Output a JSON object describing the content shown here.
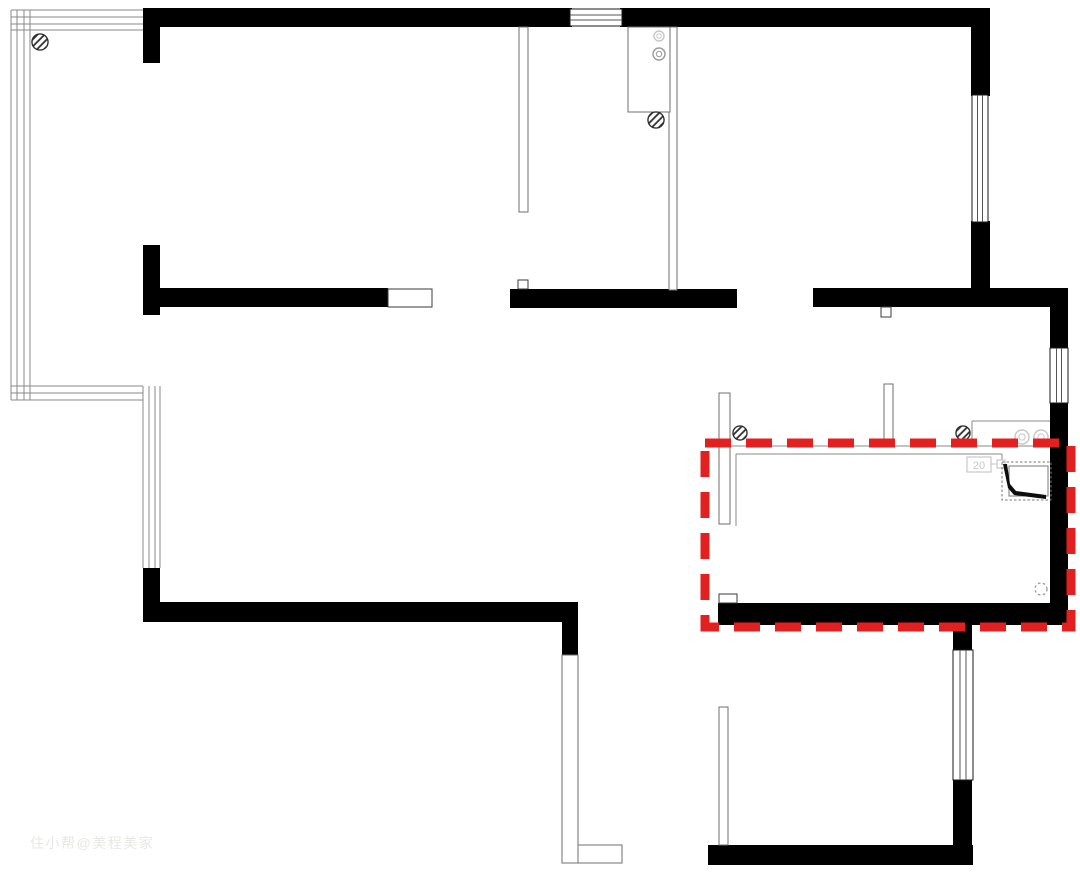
{
  "canvas": {
    "w": 1080,
    "h": 875,
    "bg": "#ffffff"
  },
  "colors": {
    "wall": "#000000",
    "thin": "#8a8a8a",
    "frame": "#3a3a3a",
    "partition": "#6f6f6f",
    "window_frame": "#1a1a1a",
    "window_mullion": "#555555",
    "fixture": "#9a9a9a",
    "faint": "#c7c7c7",
    "red": "#e32020",
    "watermark": "#e7e7e4"
  },
  "watermark": {
    "text": "住小帮@美程美家"
  },
  "labels": {
    "washer_label": "20"
  },
  "floorplan": {
    "highlight": {
      "x": 705,
      "y": 443,
      "w": 366,
      "h": 184,
      "stroke_width": 9,
      "dash": "26 15"
    },
    "walls": [
      {
        "x": 143,
        "y": 8,
        "w": 429,
        "h": 19
      },
      {
        "x": 620,
        "y": 8,
        "w": 370,
        "h": 19
      },
      {
        "x": 143,
        "y": 8,
        "w": 17,
        "h": 55
      },
      {
        "x": 971,
        "y": 8,
        "w": 19,
        "h": 88
      },
      {
        "x": 971,
        "y": 221,
        "w": 19,
        "h": 86
      },
      {
        "x": 813,
        "y": 288,
        "w": 255,
        "h": 19
      },
      {
        "x": 1050,
        "y": 307,
        "w": 18,
        "h": 42
      },
      {
        "x": 1050,
        "y": 402,
        "w": 18,
        "h": 223
      },
      {
        "x": 510,
        "y": 289,
        "w": 227,
        "h": 19
      },
      {
        "x": 143,
        "y": 245,
        "w": 17,
        "h": 70
      },
      {
        "x": 160,
        "y": 288,
        "w": 228,
        "h": 19
      },
      {
        "x": 143,
        "y": 568,
        "w": 17,
        "h": 54
      },
      {
        "x": 160,
        "y": 602,
        "w": 418,
        "h": 20
      },
      {
        "x": 562,
        "y": 602,
        "w": 16,
        "h": 53
      },
      {
        "x": 718,
        "y": 603,
        "w": 350,
        "h": 22
      },
      {
        "x": 953,
        "y": 625,
        "w": 19,
        "h": 26
      },
      {
        "x": 953,
        "y": 779,
        "w": 19,
        "h": 86
      },
      {
        "x": 708,
        "y": 845,
        "w": 265,
        "h": 20
      }
    ],
    "windows": [
      {
        "x": 570,
        "y": 9,
        "w": 52,
        "h": 17,
        "o": "h"
      },
      {
        "x": 972,
        "y": 95,
        "w": 16,
        "h": 127,
        "o": "v"
      },
      {
        "x": 1050,
        "y": 348,
        "w": 18,
        "h": 55,
        "o": "v"
      },
      {
        "x": 953,
        "y": 650,
        "w": 20,
        "h": 130,
        "o": "v"
      }
    ],
    "bay": {
      "v_x": [
        11,
        17,
        24,
        30
      ],
      "v_y1": 10,
      "v_y2": 400,
      "h_y": [
        10,
        17,
        24,
        30
      ],
      "h_x1": 11,
      "h_x2": 143,
      "b_y": [
        386,
        393,
        400
      ],
      "b_x1": 11,
      "b_x2": 143,
      "c_x": [
        143,
        149,
        155,
        160
      ],
      "c_y1": 386,
      "c_y2": 568
    },
    "partitions": [
      {
        "x": 519,
        "y": 27,
        "w": 9,
        "h": 185,
        "n": "partition"
      },
      {
        "x": 669,
        "y": 27,
        "w": 8,
        "h": 263,
        "n": "partition"
      },
      {
        "x": 884,
        "y": 384,
        "w": 9,
        "h": 62,
        "n": "partition"
      },
      {
        "x": 719,
        "y": 393,
        "w": 11,
        "h": 131,
        "n": "partition"
      },
      {
        "x": 719,
        "y": 707,
        "w": 9,
        "h": 138,
        "n": "partition"
      },
      {
        "x": 562,
        "y": 655,
        "w": 16,
        "h": 208,
        "n": "balcony-railing"
      },
      {
        "x": 578,
        "y": 845,
        "w": 44,
        "h": 18,
        "n": "balcony-railing"
      },
      {
        "x": 628,
        "y": 27,
        "w": 42,
        "h": 85,
        "n": "kitchen-counter"
      }
    ],
    "frames": [
      {
        "x": 388,
        "y": 289,
        "w": 44,
        "h": 18,
        "n": "cased-opening"
      },
      {
        "x": 518,
        "y": 280,
        "w": 10,
        "h": 9,
        "n": "door-frame"
      },
      {
        "x": 881,
        "y": 307,
        "w": 10,
        "h": 10,
        "n": "door-frame"
      },
      {
        "x": 719,
        "y": 594,
        "w": 18,
        "h": 9,
        "n": "door-frame"
      }
    ],
    "lines": [
      {
        "x1": 710,
        "y1": 446,
        "x2": 1050,
        "y2": 446
      },
      {
        "x1": 736,
        "y1": 454,
        "x2": 1002,
        "y2": 454
      },
      {
        "x1": 736,
        "y1": 454,
        "x2": 736,
        "y2": 526
      },
      {
        "x1": 1002,
        "y1": 454,
        "x2": 1002,
        "y2": 463
      },
      {
        "x1": 972,
        "y1": 421,
        "x2": 1050,
        "y2": 421
      },
      {
        "x1": 972,
        "y1": 421,
        "x2": 972,
        "y2": 446
      }
    ],
    "hatched_circles": [
      {
        "cx": 40,
        "cy": 42,
        "r": 8
      },
      {
        "cx": 656,
        "cy": 120,
        "r": 8
      },
      {
        "cx": 740,
        "cy": 433,
        "r": 7
      },
      {
        "cx": 963,
        "cy": 433,
        "r": 7
      }
    ],
    "ring_circles": [
      {
        "cx": 659,
        "cy": 36,
        "r": 5,
        "tone": "light"
      },
      {
        "cx": 659,
        "cy": 54,
        "r": 6,
        "tone": "mid"
      },
      {
        "cx": 1022,
        "cy": 437,
        "r": 7,
        "tone": "light"
      },
      {
        "cx": 1041,
        "cy": 437,
        "r": 7,
        "tone": "light"
      }
    ],
    "dashed_circle": {
      "cx": 1041,
      "cy": 589,
      "r": 6
    },
    "washer": {
      "box": {
        "x": 967,
        "y": 457,
        "w": 24,
        "h": 15
      },
      "link": {
        "x1": 991,
        "y1": 464,
        "x2": 997,
        "y2": 464
      },
      "plug": {
        "x": 997,
        "y": 460,
        "w": 8,
        "h": 8
      }
    },
    "shower": {
      "outer": {
        "x": 1002,
        "y": 462,
        "w": 49,
        "h": 38
      },
      "inner": {
        "x": 1009,
        "y": 466,
        "w": 39,
        "h": 30
      },
      "wedge": "1003,464 1008,488 1014,495 1046,499 1046,495 1016,491 1010,484 1007,464"
    }
  }
}
